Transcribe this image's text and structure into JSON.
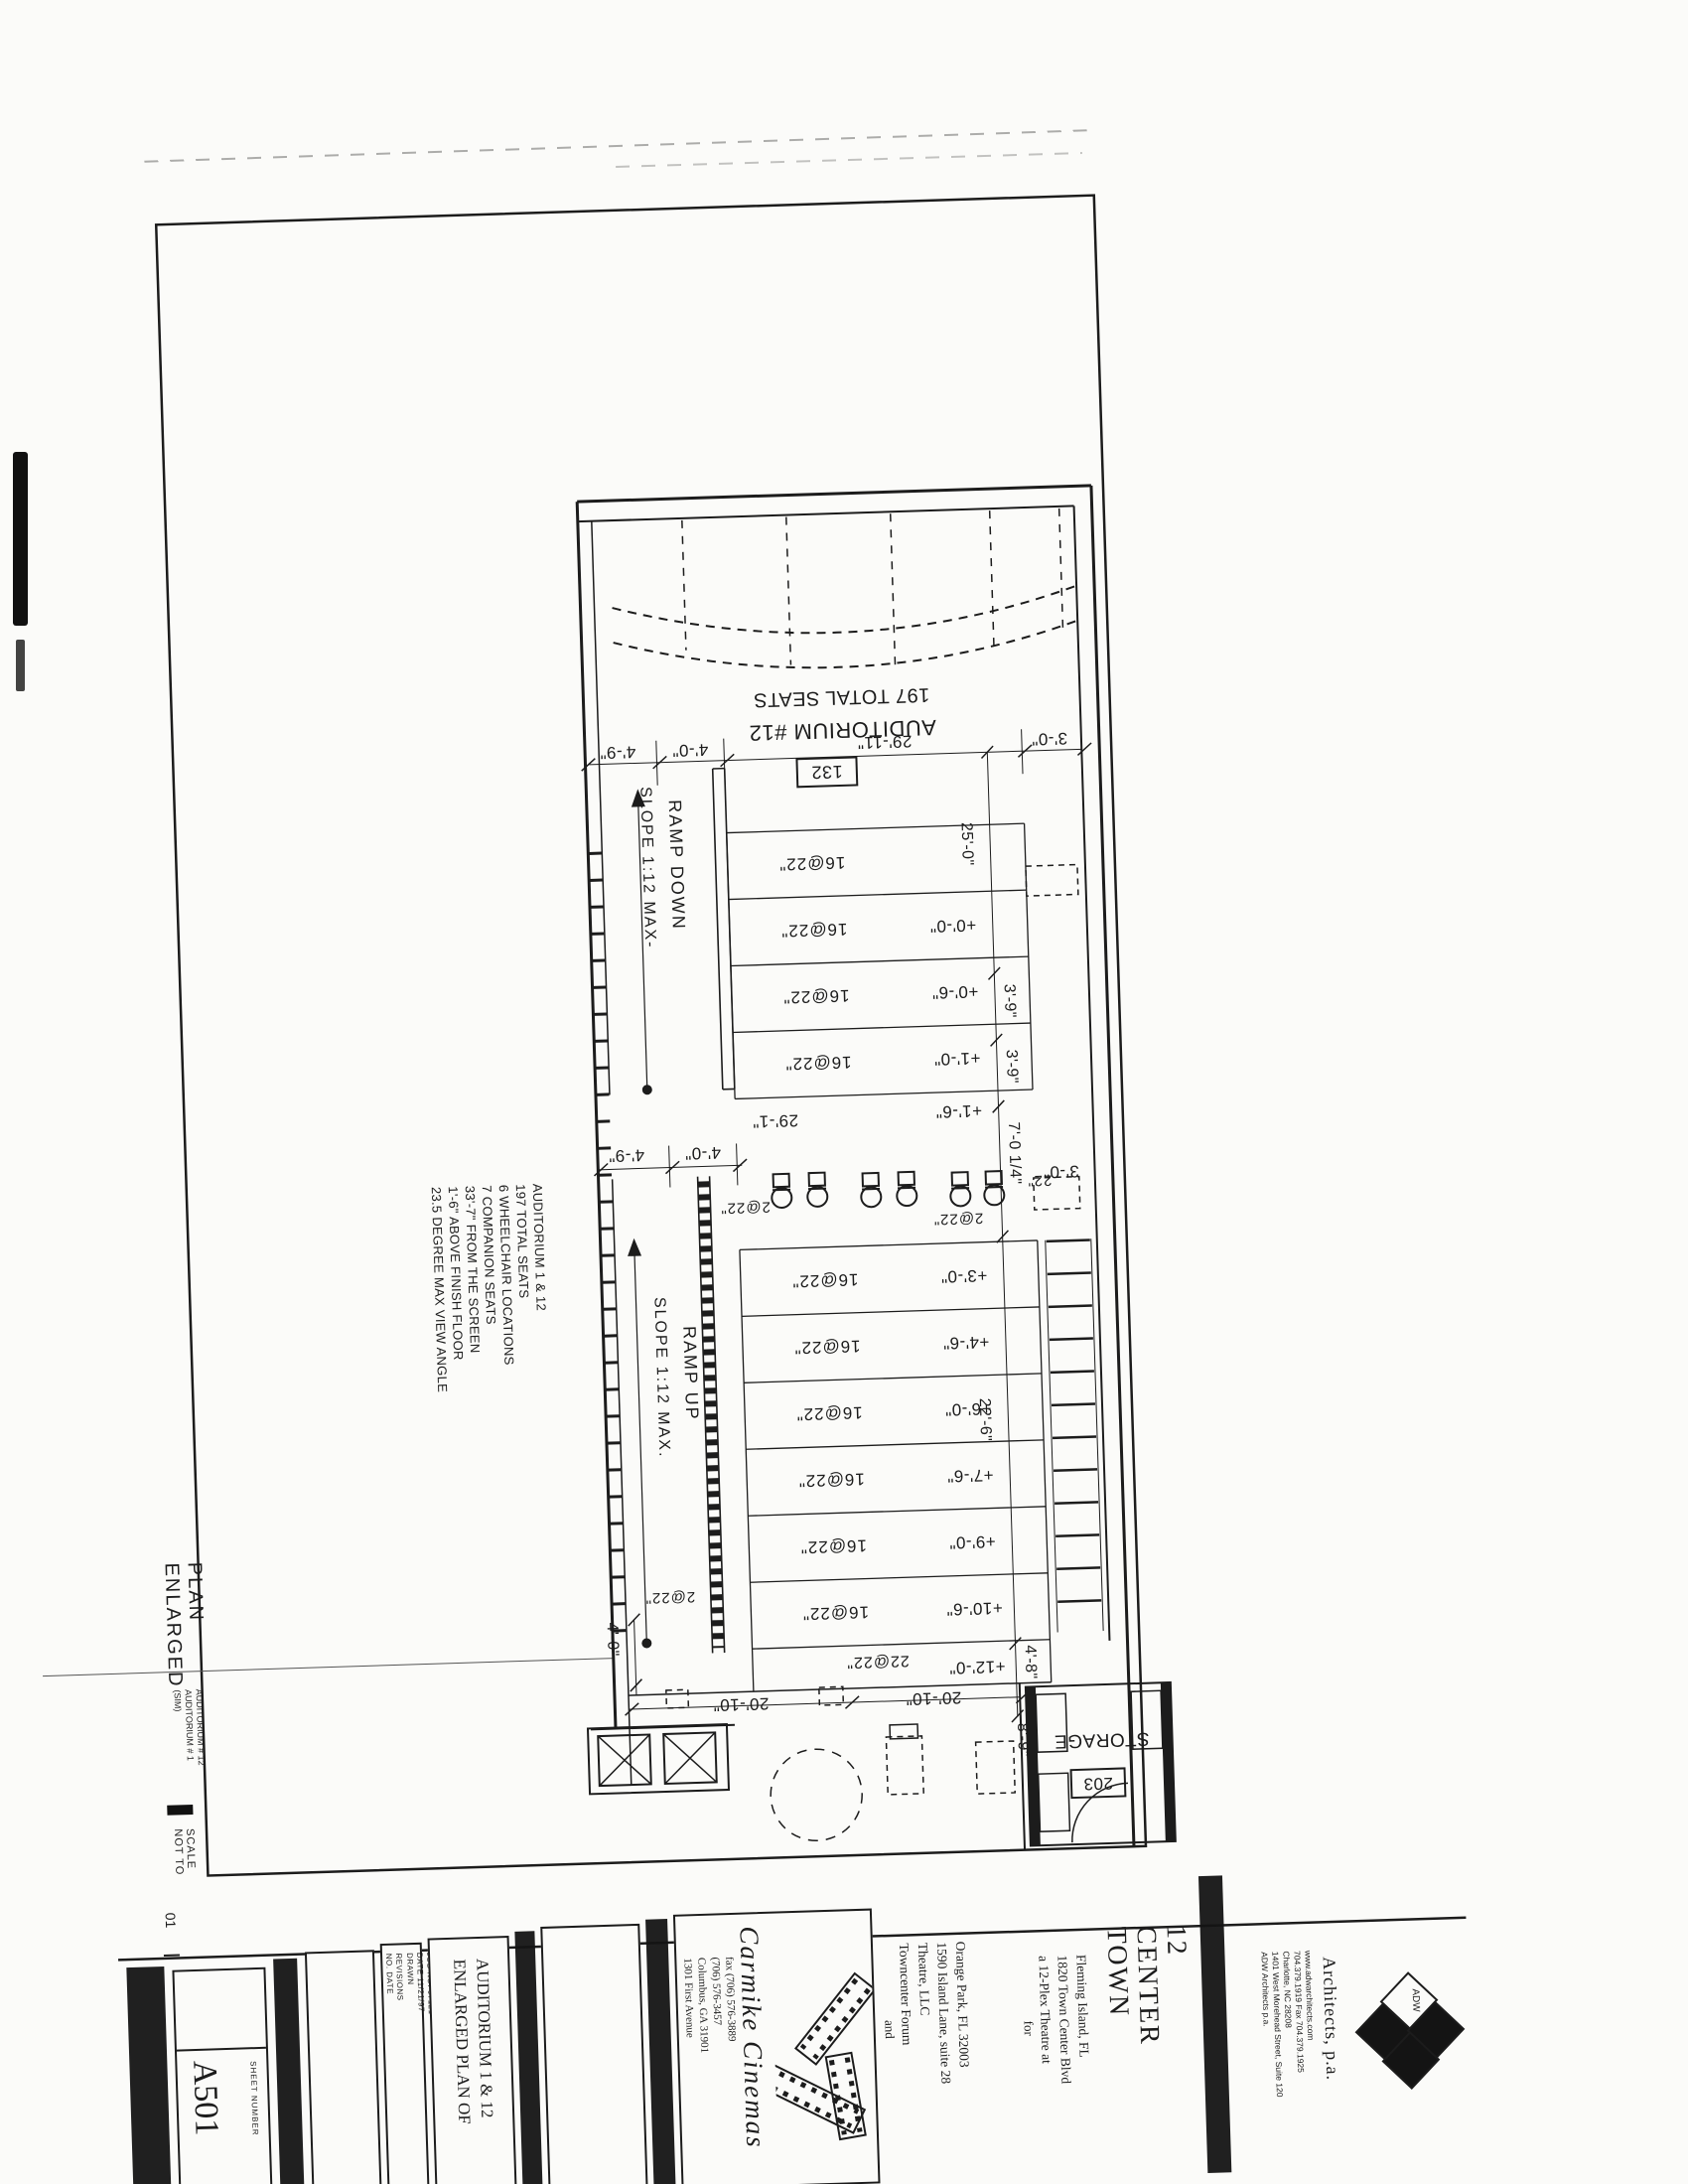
{
  "plan": {
    "auditorium_title": "AUDITORIUM #12",
    "total_seats": "197 TOTAL SEATS",
    "room_number": "132",
    "storage_label": "STORAGE",
    "storage_number": "203",
    "ramp_down": "RAMP DOWN",
    "slope_down": "SLOPE 1:12 MAX-",
    "ramp_up": "RAMP UP",
    "slope_up": "SLOPE 1:12 MAX.",
    "rows_upper": [
      "16@22\"",
      "16@22\"",
      "16@22\"",
      "16@22\""
    ],
    "rows_lower": [
      "16@22\"",
      "16@22\"",
      "16@22\"",
      "16@22\"",
      "16@22\"",
      "16@22\""
    ],
    "row_rear": "22@22\"",
    "aisle_labels": [
      "2@22\"",
      "2@22\"",
      "22\""
    ],
    "companion_row_label": "2@22\"",
    "elevations_upper": [
      "+0'-0\"",
      "+0'-6\"",
      "+1'-0\"",
      "+1'-6\""
    ],
    "elevations_lower": [
      "+3'-0\"",
      "+4'-6\"",
      "+6'-0\"",
      "+7'-6\"",
      "+9'-0\"",
      "+10'-6\""
    ],
    "elevation_rear": "+12'-0\"",
    "dims": {
      "top": [
        "4'-9\"",
        "4'-0\"",
        "29'-11\"",
        "3'-0\""
      ],
      "mid": [
        "4'-9\"",
        "4'-0\""
      ],
      "aisle_width": "29'-1\"",
      "aisle_right": "3'-0\"",
      "chain": [
        "25'-0\"",
        "3'-9\"",
        "3'-9\"",
        "7'-0 1/4\"",
        "22'-6\"",
        "4'-8\""
      ],
      "vomitory": [
        "20'-10\"",
        "20'-10\""
      ],
      "vomitory_depth": "4'-0\"",
      "storage_width": "8'-9\""
    }
  },
  "notes": {
    "lines": [
      "AUDITORIUM 1 & 12",
      "197 TOTAL SEATS",
      "6 WHEELCHAIR LOCATIONS",
      "7 COMPANION SEATS",
      "33'-7\" FROM THE SCREEN",
      "1'-6\" ABOVE FINISH FLOOR",
      "23.5 DEGREE MAX VIEW ANGLE"
    ]
  },
  "viewport": {
    "title": "ENLARGED PLAN",
    "subtitle_1": "AUDITORIUM # 12",
    "subtitle_2": "AUDITORIUM # 1 (SIM)",
    "scale": "NOT TO SCALE",
    "number": "01"
  },
  "titleblock": {
    "sheet_number_label": "SHEET NUMBER",
    "sheet_number": "A501",
    "revisions_col": [
      "NO. DATE",
      "REVISIONS"
    ],
    "admin_col": [
      "DRAWN",
      "DATE 11/21/97",
      "JOB NO. 07121"
    ],
    "sheet_title": [
      "ENLARGED PLAN OF",
      "AUDITORIUM 1 & 12"
    ],
    "carmike_name": "Carmike Cinemas",
    "carmike_address": [
      "1301 First Avenue",
      "Columbus, GA 31901",
      "(706) 576-3457",
      "fax (706) 576-3889"
    ],
    "and_label": "and",
    "owner": [
      "Towncenter Forum",
      "Theatre, LLC",
      "1590 Island Lane, suite 28",
      "Orange Park, FL 32003"
    ],
    "for_label": "for",
    "project": [
      "a 12-Plex Theatre at",
      "1820 Town Center Blvd",
      "Fleming Island, FL"
    ],
    "project_name": [
      "TOWN",
      "CENTER",
      "12"
    ],
    "architect_name": "Architects, p.a.",
    "architect_logo": "ADW",
    "architect_address": [
      "ADW Architects p.a.",
      "1401 West Morehead Street, Suite 120",
      "Charlotte, NC 28208",
      "704.379.1919  Fax 704.379.1925",
      "www.adwarchitects.com"
    ]
  }
}
